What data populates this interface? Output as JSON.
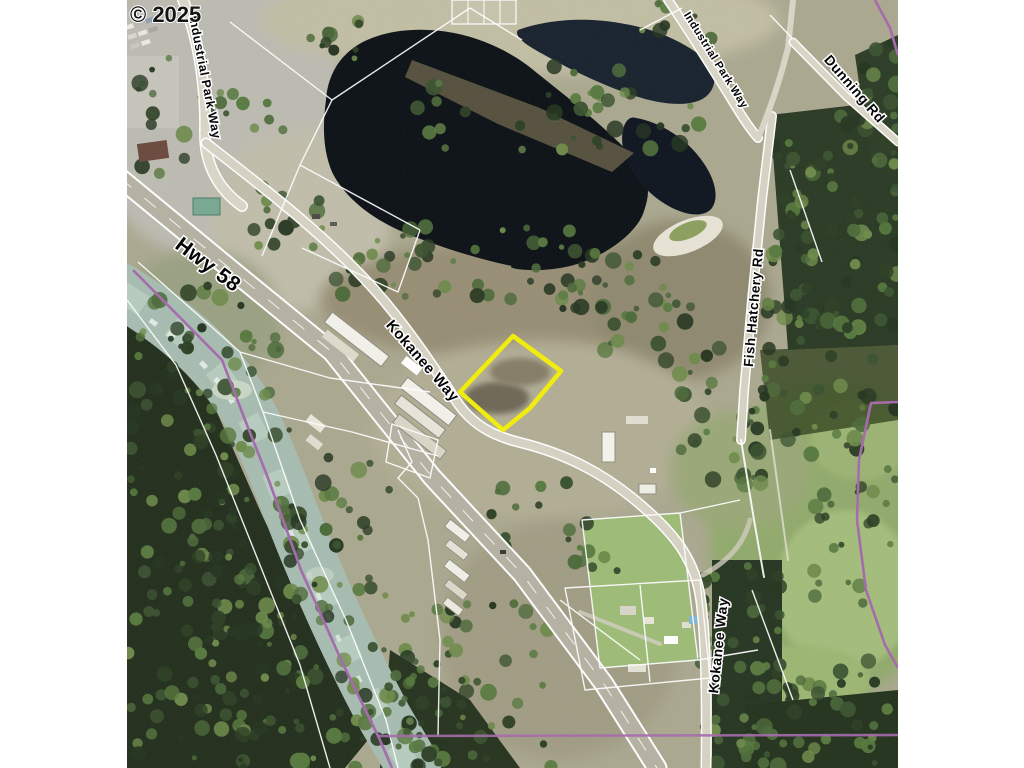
{
  "copyright": "© 2025",
  "road_labels": {
    "industrial_park_way_west": "Industrial Park Way",
    "hwy_58": "Hwy 58",
    "kokanee_way_mid": "Kokanee Way",
    "industrial_park_way_north": "Industrial Park Way",
    "dunning_rd": "Dunning Rd",
    "fish_hatchery_rd": "Fish Hatchery Rd",
    "kokanee_way_south": "Kokanee Way"
  },
  "colors": {
    "background": "#ffffff",
    "parcel_highlight": "#f2ee0a",
    "boundary_line": "#a569ad",
    "pond_water": "#0c1117",
    "river_water": "#a7bcb1",
    "label_fill": "#050505",
    "label_halo": "#ffffff"
  }
}
